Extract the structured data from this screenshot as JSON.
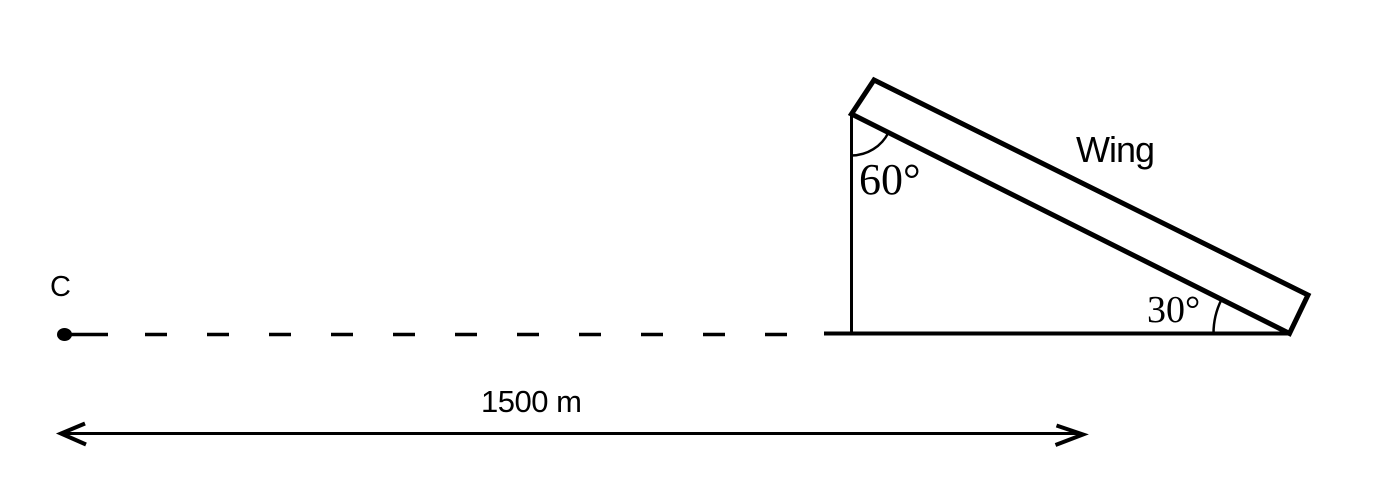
{
  "colors": {
    "ink": "#000000",
    "background": "#ffffff"
  },
  "labels": {
    "point_c": "C",
    "top_angle": "60°",
    "bottom_angle": "30°",
    "wing": "Wing",
    "distance": "1500 m"
  }
}
